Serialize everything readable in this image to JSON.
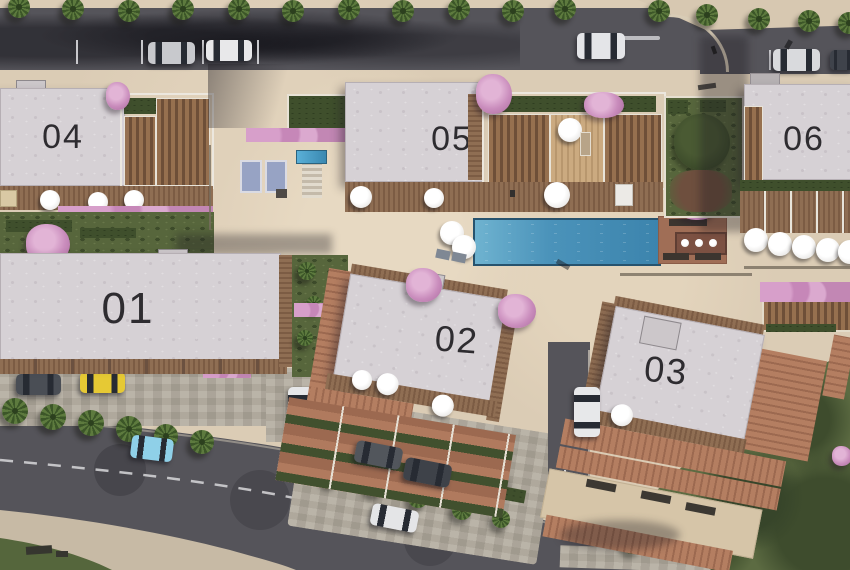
{
  "scene": {
    "view": "aerial-3d-site-plan",
    "orientation": "top-down"
  },
  "buildings": [
    {
      "id": "building-01",
      "label": "01"
    },
    {
      "id": "building-02",
      "label": "02"
    },
    {
      "id": "building-03",
      "label": "03"
    },
    {
      "id": "building-04",
      "label": "04"
    },
    {
      "id": "building-05",
      "label": "05"
    },
    {
      "id": "building-06",
      "label": "06"
    }
  ],
  "amenities": {
    "main_pool": "rectangular-swimming-pool",
    "plunge_pool": "small-courtyard-pool",
    "sun_loungers": "courtyard-sun-loungers",
    "parasols": "white-parasols-on-decks",
    "pergola_seating": "poolside-pergola-table",
    "gardens": "landscaped-gardens-with-pink-blossom-trees",
    "street_parking": "parallel-parking-bays-top-road"
  },
  "vehicles": [
    {
      "color": "silver",
      "location": "top-road-parking-bay"
    },
    {
      "color": "white",
      "location": "top-road-parking-bay"
    },
    {
      "color": "white",
      "location": "top-road-center"
    },
    {
      "color": "silver",
      "location": "top-road-right"
    },
    {
      "color": "dark-gray",
      "location": "top-road-right-edge"
    },
    {
      "color": "dark-gray",
      "location": "parking-lot-left"
    },
    {
      "color": "yellow",
      "location": "parking-lot-left"
    },
    {
      "color": "white",
      "location": "driveway-beside-building-01"
    },
    {
      "color": "light-blue",
      "location": "curved-road"
    },
    {
      "color": "dark-gray",
      "location": "plaza-parking"
    },
    {
      "color": "dark-gray",
      "location": "plaza-parking"
    },
    {
      "color": "white",
      "location": "plaza-parking"
    },
    {
      "color": "white",
      "location": "driveway-beside-building-03"
    }
  ],
  "colors": {
    "paving_beige": "#dbccb5",
    "asphalt_gray": "#55545a",
    "flat_roof_white": "#d6d1d5",
    "deck_wood_brown": "#8a6950",
    "terracotta_roof": "#ac765b",
    "pool_water_blue": "#4b93ba",
    "grass_green": "#5a6a40",
    "hedge_green": "#3f4f2c",
    "blossom_pink": "#cf9ac4",
    "car_yellow": "#e5c735",
    "car_light_blue": "#8ed0e6"
  }
}
